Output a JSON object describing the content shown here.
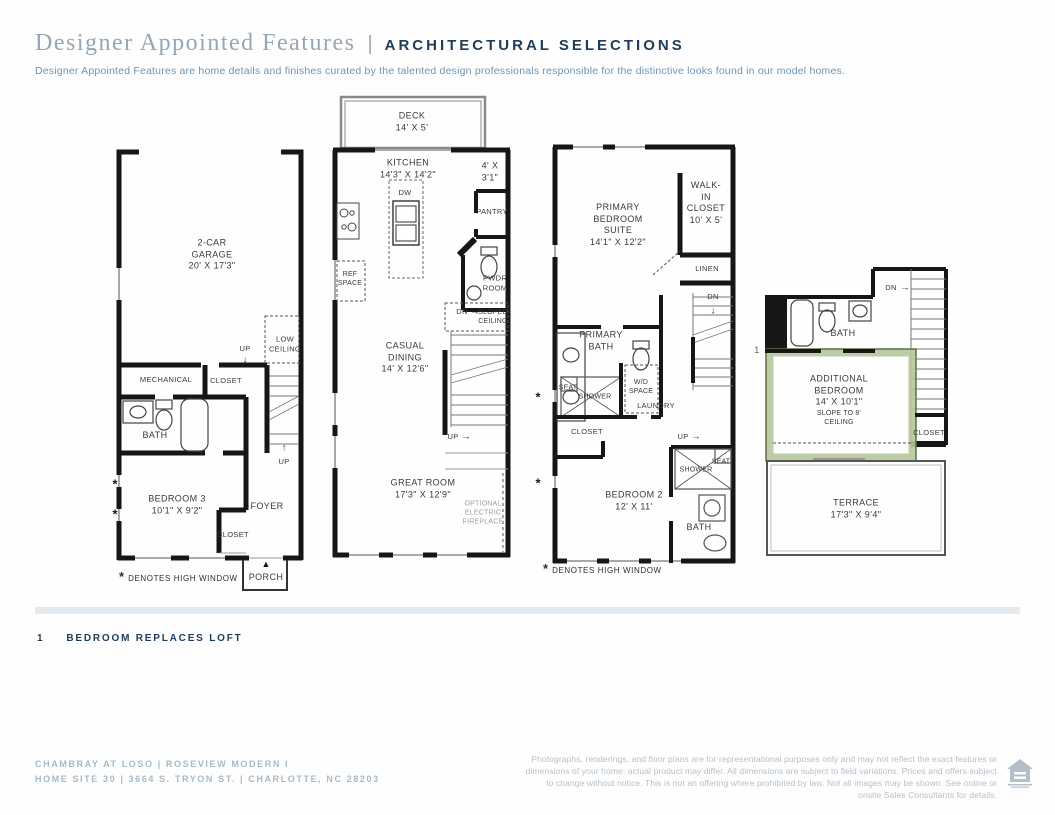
{
  "header": {
    "title": "Designer Appointed Features",
    "separator": "|",
    "section": "ARCHITECTURAL SELECTIONS",
    "description": "Designer Appointed Features are home details and finishes curated by the talented design professionals responsible for the distinctive looks found in our model homes."
  },
  "icons": {
    "up_arrow": "↑",
    "down_arrow": "↓",
    "right_arrow": "→",
    "porch_marker": "▲",
    "asterisk": "*",
    "equal_housing_logo": "equal-housing-opportunity"
  },
  "plans": {
    "floor1": {
      "garage": "2-CAR\nGARAGE\n20' X 17'3\"",
      "up_garage": "UP",
      "low_ceiling": "LOW\nCEILING",
      "mechanical": "MECHANICAL",
      "closet_top": "CLOSET",
      "bath": "BATH",
      "up_foyer": "UP",
      "bedroom3": "BEDROOM 3\n10'1\" X 9'2\"",
      "foyer": "FOYER",
      "closet_bottom": "CLOSET",
      "porch": "PORCH",
      "high_window_note": "DENOTES HIGH WINDOW"
    },
    "floor2": {
      "deck": "DECK\n14' X 5'",
      "kitchen": "KITCHEN\n14'3\" X 14'2\"",
      "pantry_dims": "4' X 3'1\"",
      "dw": "DW",
      "pantry": "PANTRY",
      "ref_space": "REF\nSPACE",
      "pwdr_room": "PWDR\nROOM",
      "dn": "DN",
      "sloped_ceiling": "SLOPED\nCEILING",
      "casual_dining": "CASUAL\nDINING\n14' X 12'6\"",
      "up": "UP",
      "great_room": "GREAT ROOM\n17'3\" X 12'9\"",
      "optional_fireplace": "OPTIONAL\nELECTRIC\nFIREPLACE"
    },
    "floor3": {
      "primary_suite": "PRIMARY\nBEDROOM\nSUITE\n14'1\" X 12'2\"",
      "walk_in_closet": "WALK-IN\nCLOSET\n10' X 5'",
      "linen": "LINEN",
      "dn": "DN",
      "primary_bath": "PRIMARY\nBATH",
      "seat_1": "SEAT",
      "shower_1": "SHOWER",
      "wd_space": "W/D\nSPACE",
      "laundry": "LAUNDRY",
      "closet": "CLOSET",
      "up": "UP",
      "bedroom2": "BEDROOM 2\n12' X 11'",
      "shower_2": "SHOWER",
      "seat_2": "SEAT",
      "bath": "BATH",
      "high_window_note": "DENOTES HIGH WINDOW"
    },
    "floor4": {
      "dn": "DN",
      "bath": "BATH",
      "option_marker": "1",
      "additional_bedroom": "ADDITIONAL\nBEDROOM\n14' X 10'1\"",
      "slope_note": "SLOPE TO 8'\nCEILING",
      "closet": "CLOSET",
      "terrace": "TERRACE\n17'3\" X 9'4\""
    }
  },
  "footnote": {
    "number": "1",
    "text": "BEDROOM REPLACES LOFT"
  },
  "footer": {
    "community": "CHAMBRAY AT LOSO | ROSEVIEW MODERN I\nHOME SITE 30  |  3664 S. TRYON ST.  |  CHARLOTTE, NC 28203",
    "disclaimer": "Photographs, renderings, and floor plans are for representational purposes only and may not reflect the exact features or dimensions of your home; actual product may differ. All dimensions are subject to field variations. Prices and offers subject to change without notice. This is not an offering where prohibited by law. Not all images may be shown. See online or onsite Sales Consultants for details."
  },
  "colors": {
    "navy": "#1F3C5A",
    "title_blue_gray": "#96A6B4",
    "description_blue": "#6D94B4",
    "footer_blue": "#A6BAC9",
    "divider_gray": "#E4E9EE",
    "wall_black": "#161616",
    "highlight_green_dark": "#5C7040",
    "highlight_green_light": "#B7C79B"
  }
}
